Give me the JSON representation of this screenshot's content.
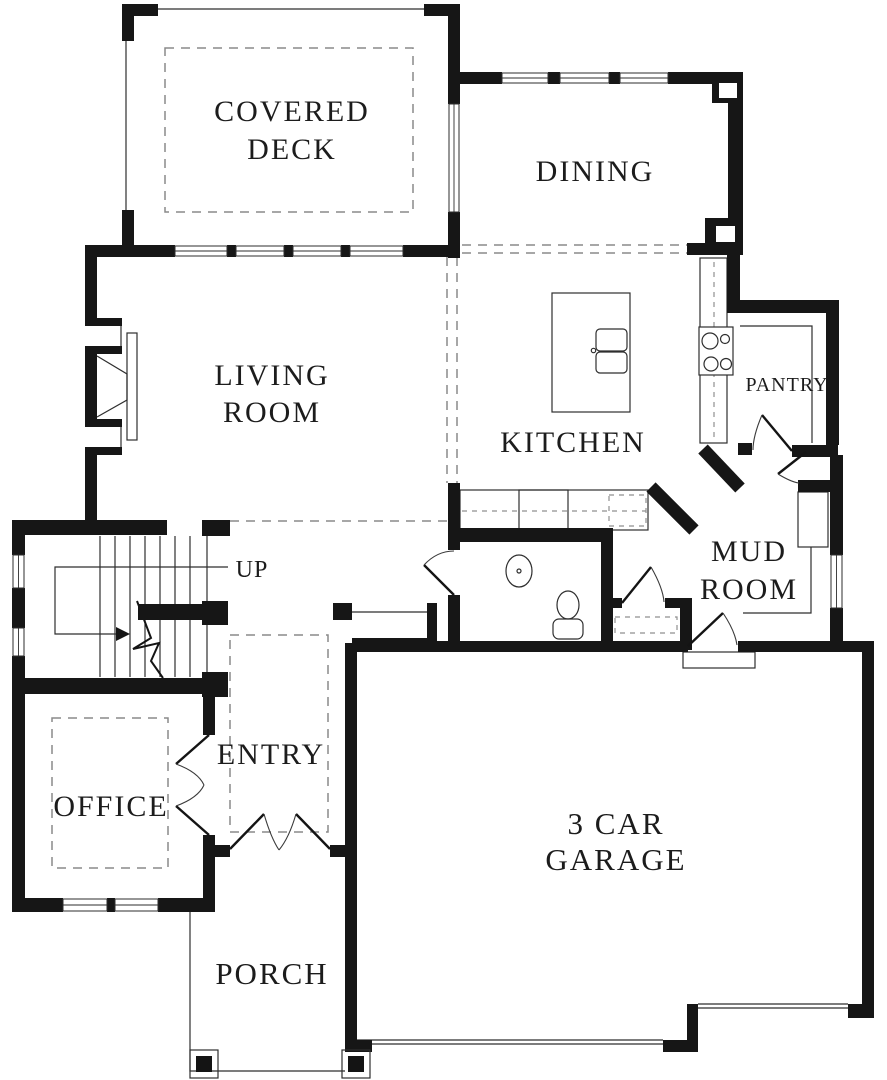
{
  "floor_plan": {
    "rooms": {
      "covered_deck": {
        "line1": "COVERED",
        "line2": "DECK"
      },
      "dining": {
        "label": "DINING"
      },
      "living_room": {
        "line1": "LIVING",
        "line2": "ROOM"
      },
      "kitchen": {
        "label": "KITCHEN"
      },
      "pantry": {
        "label": "PANTRY"
      },
      "mud_room": {
        "line1": "MUD",
        "line2": "ROOM"
      },
      "stairs": {
        "label": "UP"
      },
      "entry": {
        "label": "ENTRY"
      },
      "office": {
        "label": "OFFICE"
      },
      "porch": {
        "label": "PORCH"
      },
      "garage": {
        "line1": "3 CAR",
        "line2": "GARAGE"
      }
    },
    "colors": {
      "wall": "#161616",
      "thin_line": "#2e2e2e",
      "dashed_line": "#8a8a8a",
      "label_text": "#1c1c1c",
      "background": "#ffffff"
    }
  }
}
